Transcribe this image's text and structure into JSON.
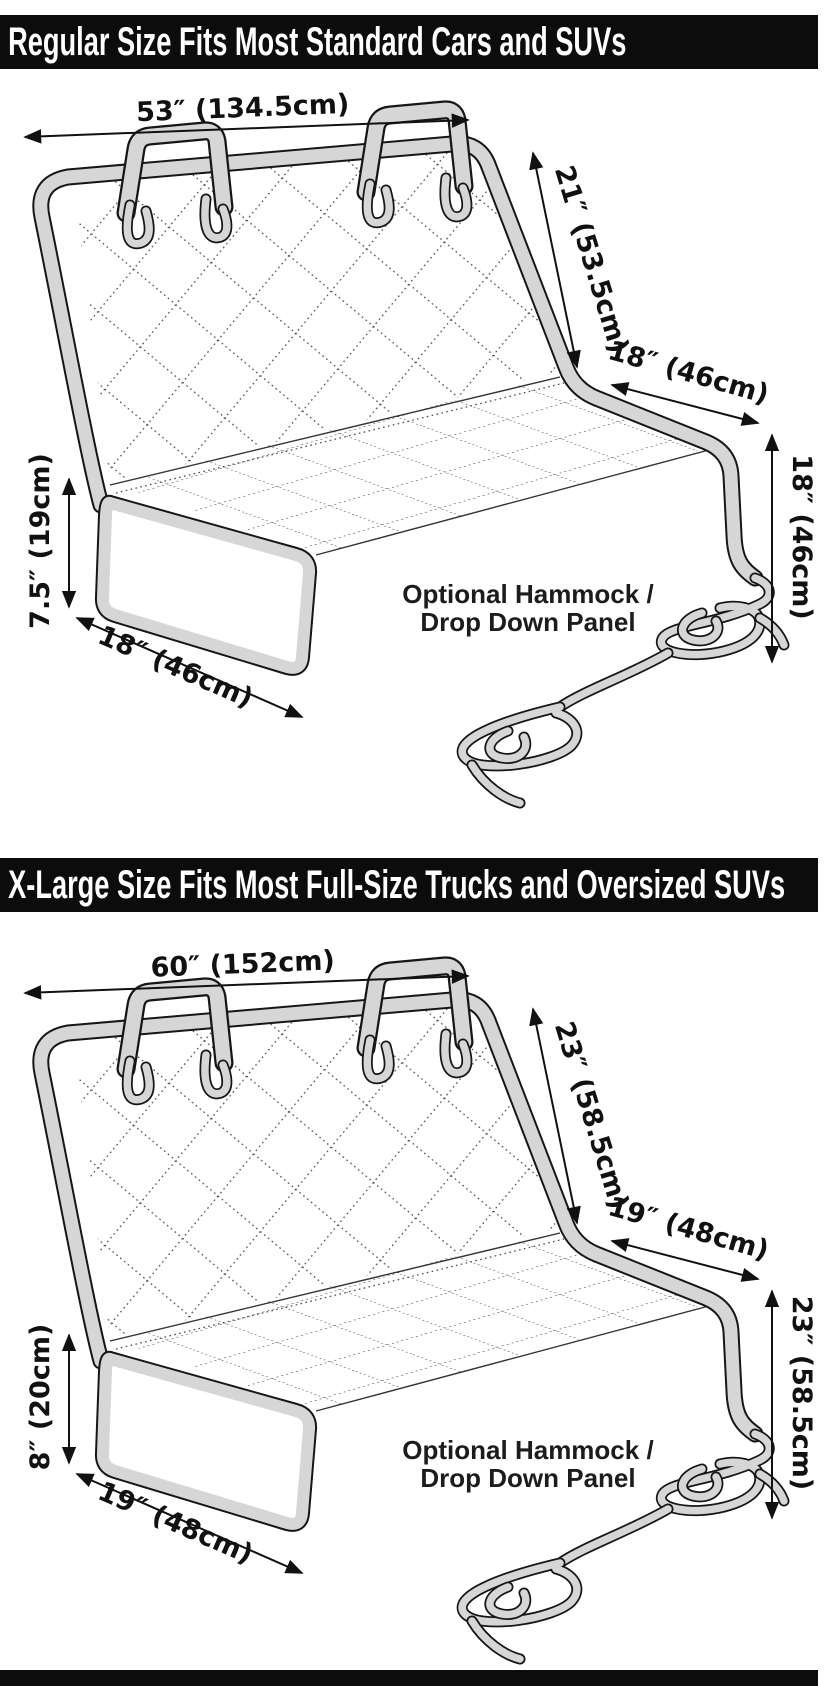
{
  "banners": [
    {
      "title": "Regular Size Fits Most Standard Cars and SUVs"
    },
    {
      "title": "X-Large Size Fits Most Full-Size Trucks and Oversized SUVs"
    }
  ],
  "diagrams": [
    {
      "size": "Regular",
      "top_width": "53″ (134.5cm)",
      "back_height": "21″ (53.5cm)",
      "seat_depth": "18″ (46cm)",
      "side_drop_height": "18″ (46cm)",
      "flap_height": "7.5″ (19cm)",
      "flap_width": "18″ (46cm)",
      "hammock_label_line1": "Optional Hammock /",
      "hammock_label_line2": "Drop Down Panel"
    },
    {
      "size": "X-Large",
      "top_width": "60″ (152cm)",
      "back_height": "23″ (58.5cm)",
      "seat_depth": "19″ (48cm)",
      "side_drop_height": "23″ (58.5cm)",
      "flap_height": "8″ (20cm)",
      "flap_width": "19″ (48cm)",
      "hammock_label_line1": "Optional Hammock /",
      "hammock_label_line2": "Drop Down Panel"
    }
  ],
  "colors": {
    "banner_bg": "#0c0c0c",
    "banner_text": "#ffffff",
    "line": "#161616",
    "tube_fill": "#d6d6d6",
    "quilt_dots": "#4d4d4d",
    "dim_text": "#111111"
  }
}
